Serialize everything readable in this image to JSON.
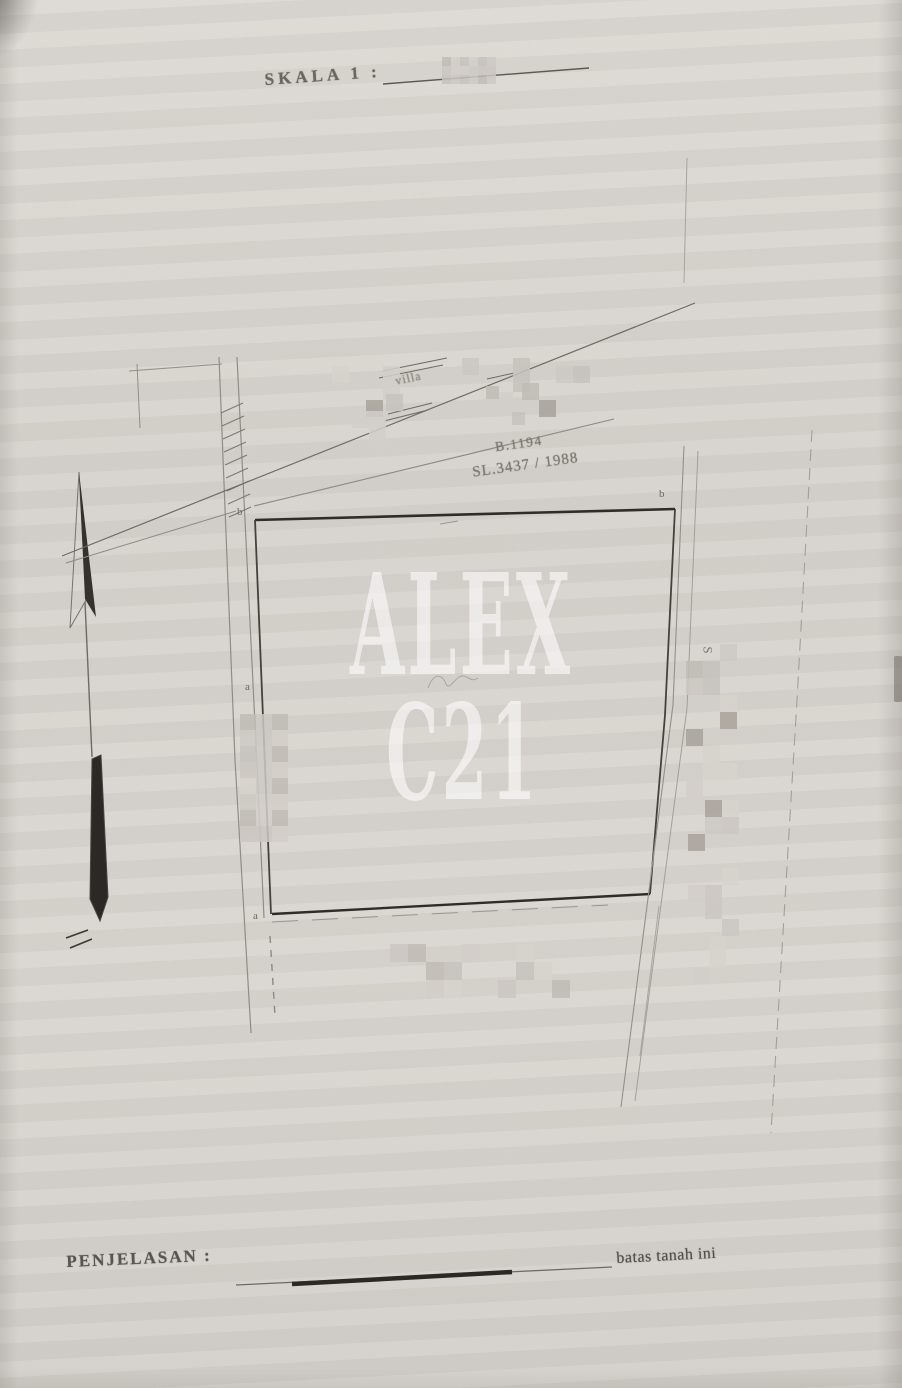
{
  "page": {
    "kind": "scanned land survey sketch",
    "scale": {
      "label": "SKALA 1 :"
    },
    "parcel": {
      "block_no": "B.1194",
      "survey_no": "SL.3437 / 1988"
    },
    "labels": {
      "villa": "villa"
    },
    "corner_marks": {
      "top_left": "b",
      "top_right": "b",
      "mid_left": "a",
      "bottom_left": "a",
      "right_side": "S"
    },
    "legend": {
      "label": "PENJELASAN :",
      "description": "batas tanah ini"
    },
    "watermark": {
      "line1": "ALEX",
      "line2": "C21"
    }
  },
  "colors": {
    "paper": "#d7d3ce",
    "ink_dark": "#2e2b28",
    "ink": "#57524c",
    "ink_faded": "#8a857f",
    "watermark": "#ffffff"
  },
  "redactions": [
    {
      "x": 442,
      "y": 57,
      "w": 52,
      "h": 19,
      "tile": 9,
      "seed": 3,
      "sparse": false
    },
    {
      "x": 332,
      "y": 366,
      "w": 52,
      "h": 48,
      "tile": 17,
      "seed": 1,
      "sparse": true
    },
    {
      "x": 352,
      "y": 394,
      "w": 48,
      "h": 44,
      "tile": 17,
      "seed": 5,
      "sparse": true
    },
    {
      "x": 462,
      "y": 358,
      "w": 64,
      "h": 44,
      "tile": 17,
      "seed": 2,
      "sparse": true
    },
    {
      "x": 522,
      "y": 366,
      "w": 68,
      "h": 42,
      "tile": 17,
      "seed": 4,
      "sparse": true
    },
    {
      "x": 486,
      "y": 386,
      "w": 36,
      "h": 28,
      "tile": 13,
      "seed": 11,
      "sparse": true
    },
    {
      "x": 686,
      "y": 644,
      "w": 38,
      "h": 150,
      "tile": 17,
      "seed": 6,
      "sparse": true
    },
    {
      "x": 688,
      "y": 800,
      "w": 38,
      "h": 132,
      "tile": 17,
      "seed": 7,
      "sparse": true
    },
    {
      "x": 694,
      "y": 936,
      "w": 32,
      "h": 78,
      "tile": 16,
      "seed": 8,
      "sparse": true
    },
    {
      "x": 240,
      "y": 714,
      "w": 38,
      "h": 118,
      "tile": 16,
      "seed": 9,
      "sparse": false
    },
    {
      "x": 390,
      "y": 944,
      "w": 176,
      "h": 52,
      "tile": 18,
      "seed": 10,
      "sparse": true
    }
  ]
}
